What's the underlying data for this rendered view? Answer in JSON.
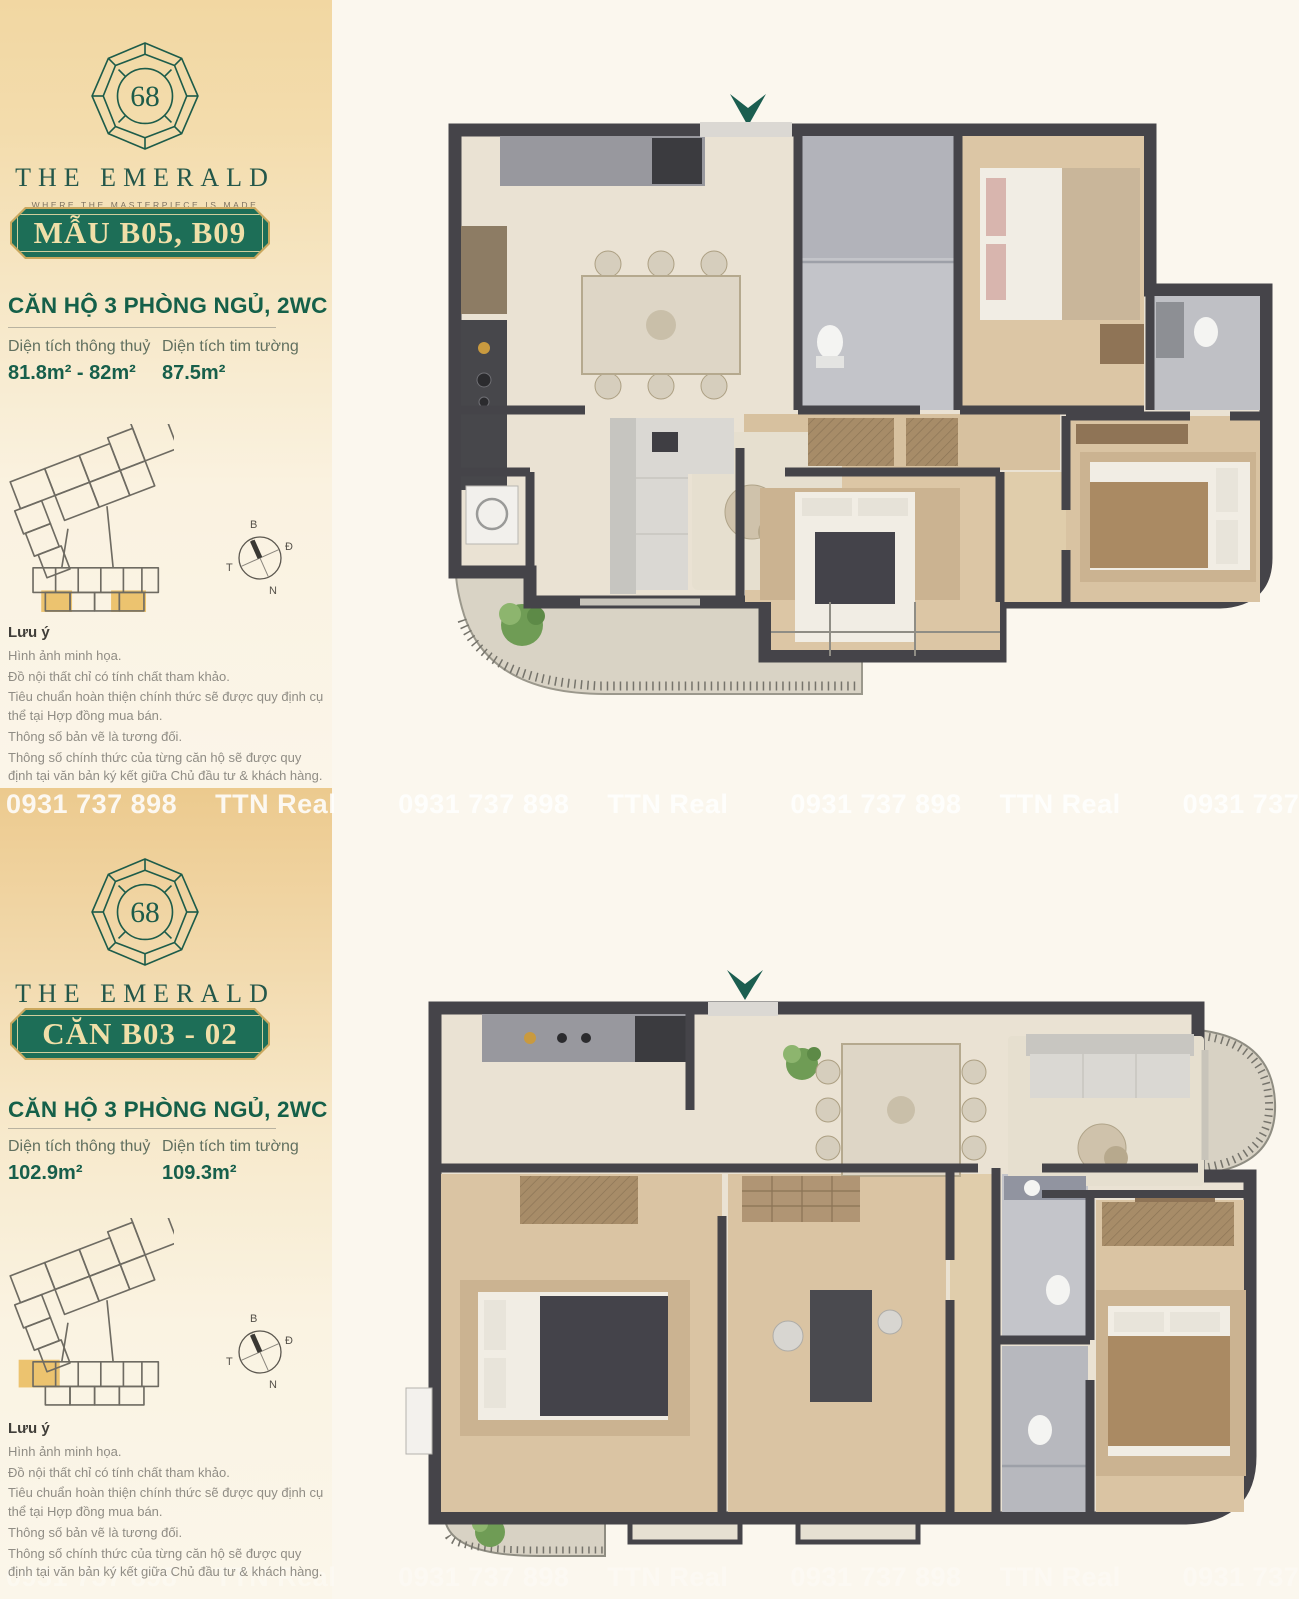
{
  "watermark": {
    "phone": "0931 737 898",
    "brand": "TTN Real"
  },
  "logo": {
    "number": "68",
    "name": "THE EMERALD",
    "tagline": "WHERE THE MASTERPIECE IS MADE"
  },
  "compass": {
    "north": "B",
    "east": "Đ",
    "west": "T",
    "south": "N"
  },
  "notes": {
    "title": "Lưu ý",
    "lines": [
      "Hình ảnh minh họa.",
      "Đồ nội thất chỉ có tính chất tham khảo.",
      "Tiêu chuẩn hoàn thiện chính thức sẽ được quy định cụ thể tại Hợp đồng mua bán.",
      "Thông số bản vẽ là tương đối.",
      "Thông số chính thức của từng căn hộ sẽ được quy định tại văn bản ký kết giữa Chủ đầu tư & khách hàng."
    ]
  },
  "panels": [
    {
      "badge": "MẪU B05, B09",
      "unit_type": "CĂN HỘ 3 PHÒNG NGỦ, 2WC",
      "areas": [
        {
          "label": "Diện tích thông thuỷ",
          "value": "81.8m² - 82m²"
        },
        {
          "label": "Diện tích tim tường",
          "value": "87.5m²"
        }
      ]
    },
    {
      "badge": "CĂN B03 - 02",
      "unit_type": "CĂN HỘ 3 PHÒNG NGỦ, 2WC",
      "areas": [
        {
          "label": "Diện tích thông thuỷ",
          "value": "102.9m²"
        },
        {
          "label": "Diện tích tim tường",
          "value": "109.3m²"
        }
      ]
    }
  ],
  "colors": {
    "brand_green": "#1d6e57",
    "gold_text": "#f0dfa8",
    "accent_teal": "#1b5e50",
    "highlight_gold": "#ecc36f",
    "wall": "#454449"
  }
}
